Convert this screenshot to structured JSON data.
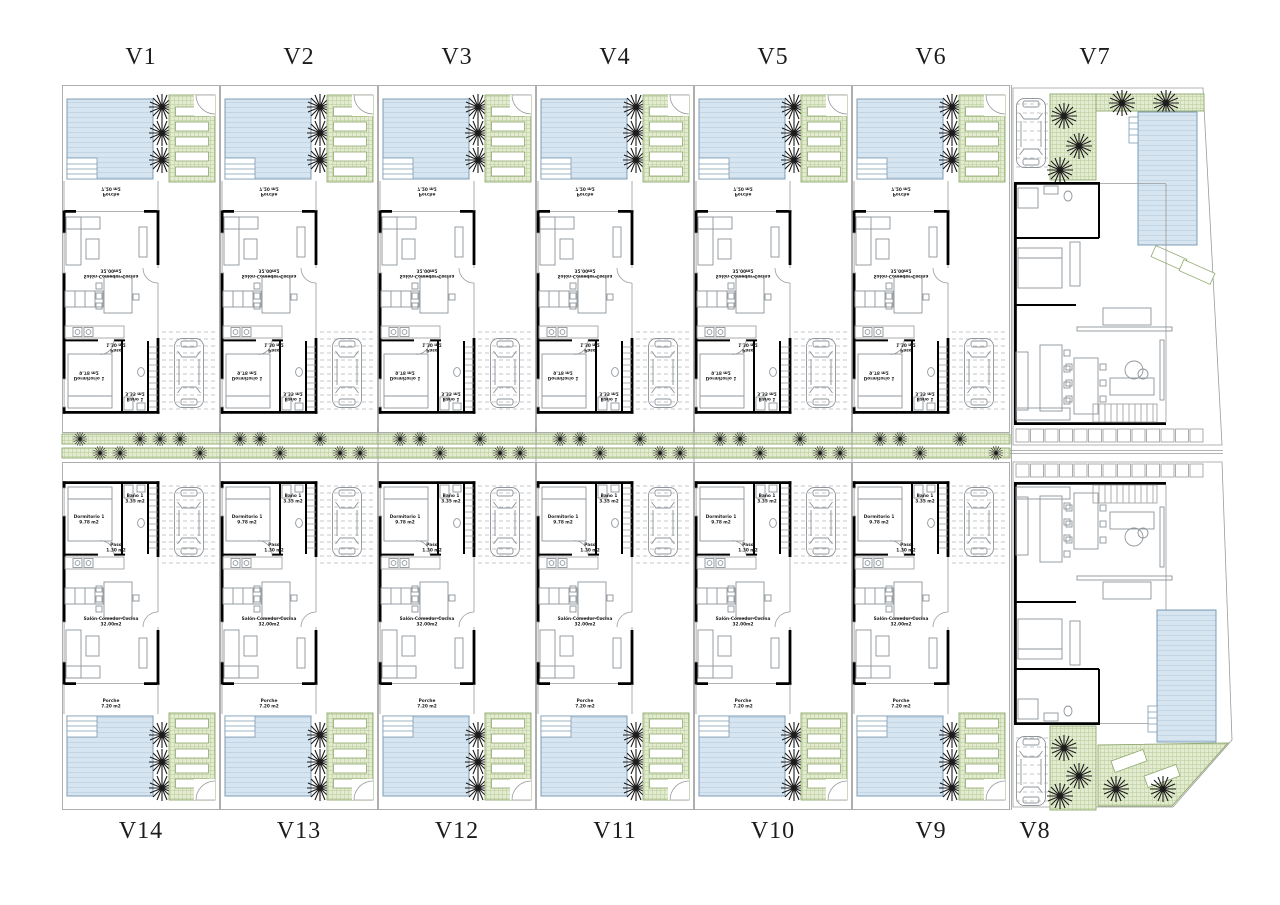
{
  "site": {
    "title": "Villas site plan",
    "top_row_labels": [
      "V1",
      "V2",
      "V3",
      "V4",
      "V5",
      "V6",
      "V7"
    ],
    "bottom_row_labels": [
      "V14",
      "V13",
      "V12",
      "V11",
      "V10",
      "V9",
      "V8"
    ]
  },
  "unit_rooms": {
    "dormitorio": "Dormitorio 1",
    "dormitorio_area": "9.78 m2",
    "bano": "Baño 1",
    "bano_area": "3.35 m2",
    "paso": "Paso",
    "paso_area": "1.30 m2",
    "salon": "Salón-Comedor-Cocina",
    "salon_area": "32.00m2",
    "porche": "Porche",
    "porche_area": "7.20 m2"
  },
  "icons": [
    {
      "name": "palm-tree-icon",
      "glyph": "✳"
    },
    {
      "name": "car-icon",
      "glyph": "▭"
    },
    {
      "name": "sun-lounger-icon",
      "glyph": "▭"
    },
    {
      "name": "door-swing-icon",
      "glyph": "◜"
    },
    {
      "name": "stairs-icon",
      "glyph": "≡"
    }
  ],
  "colors": {
    "background": "#ffffff",
    "pool_base": "#d6e5f0",
    "pool_line": "#c3d6e5",
    "pool_border": "#7d9cb4",
    "green_base": "#e3ebd1",
    "green_line": "#bfd0a1",
    "green_border": "#8fa96e",
    "wall": "#000000",
    "thin_line": "#9a9a9a",
    "furniture_line": "#8f959b",
    "dash_line": "#b5b5b5",
    "palm_color": "#1c1c1c",
    "label_text": "#1c1c1c"
  }
}
